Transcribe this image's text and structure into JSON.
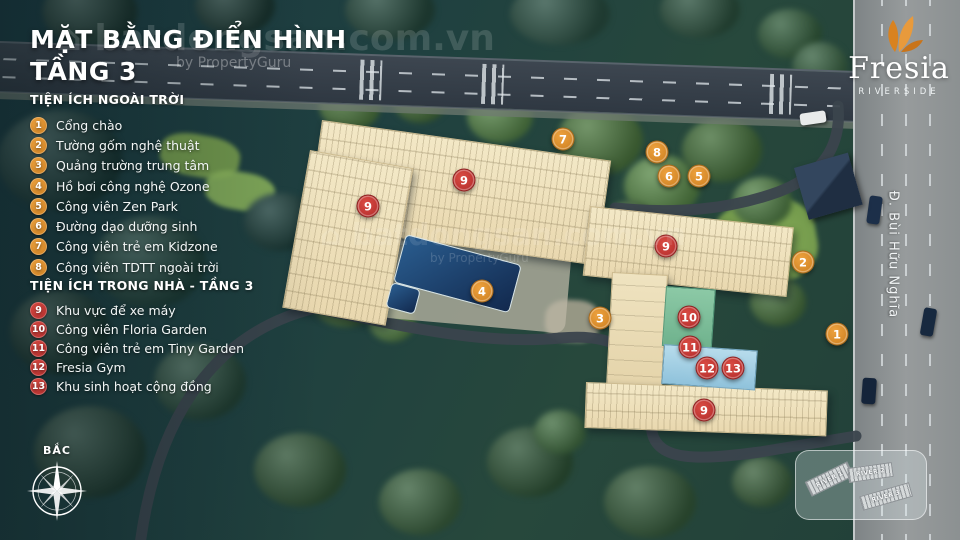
{
  "title": {
    "line1": "MẶT BẰNG ĐIỂN HÌNH",
    "line2": "TẦNG 3"
  },
  "legend_outdoor": {
    "heading": "TIỆN ÍCH NGOÀI TRỜI",
    "items": [
      {
        "num": "1",
        "label": "Cổng chào"
      },
      {
        "num": "2",
        "label": "Tường gốm nghệ thuật"
      },
      {
        "num": "3",
        "label": "Quảng trường trung tâm"
      },
      {
        "num": "4",
        "label": "Hồ bơi công nghệ Ozone"
      },
      {
        "num": "5",
        "label": "Công viên Zen Park"
      },
      {
        "num": "6",
        "label": "Đường dạo dưỡng sinh"
      },
      {
        "num": "7",
        "label": "Công viên trẻ em Kidzone"
      },
      {
        "num": "8",
        "label": "Công viên TDTT ngoài trời"
      }
    ]
  },
  "legend_indoor": {
    "heading": "TIỆN ÍCH TRONG NHÀ - TẦNG 3",
    "items": [
      {
        "num": "9",
        "label": "Khu vực để xe máy"
      },
      {
        "num": "10",
        "label": "Công viên Floria Garden"
      },
      {
        "num": "11",
        "label": "Công viên trẻ em Tiny Garden"
      },
      {
        "num": "12",
        "label": "Fresia Gym"
      },
      {
        "num": "13",
        "label": "Khu sinh hoạt cộng đồng"
      }
    ]
  },
  "logo": {
    "name": "Fresia",
    "subtitle": "RIVERSIDE"
  },
  "map": {
    "street_label": "Đ. Bùi Hữu Nghĩa",
    "markers": [
      {
        "num": "7",
        "kind": "outdoor",
        "x": 563,
        "y": 139
      },
      {
        "num": "8",
        "kind": "outdoor",
        "x": 657,
        "y": 152
      },
      {
        "num": "6",
        "kind": "outdoor",
        "x": 669,
        "y": 176
      },
      {
        "num": "5",
        "kind": "outdoor",
        "x": 699,
        "y": 176
      },
      {
        "num": "2",
        "kind": "outdoor",
        "x": 803,
        "y": 262
      },
      {
        "num": "1",
        "kind": "outdoor",
        "x": 837,
        "y": 334
      },
      {
        "num": "3",
        "kind": "outdoor",
        "x": 600,
        "y": 318
      },
      {
        "num": "4",
        "kind": "outdoor",
        "x": 482,
        "y": 291
      },
      {
        "num": "9",
        "kind": "indoor",
        "x": 368,
        "y": 206
      },
      {
        "num": "9",
        "kind": "indoor",
        "x": 464,
        "y": 180
      },
      {
        "num": "9",
        "kind": "indoor",
        "x": 666,
        "y": 246
      },
      {
        "num": "9",
        "kind": "indoor",
        "x": 704,
        "y": 410
      },
      {
        "num": "10",
        "kind": "indoor",
        "x": 689,
        "y": 317
      },
      {
        "num": "11",
        "kind": "indoor",
        "x": 690,
        "y": 347
      },
      {
        "num": "12",
        "kind": "indoor",
        "x": 707,
        "y": 368
      },
      {
        "num": "13",
        "kind": "indoor",
        "x": 733,
        "y": 368
      }
    ]
  },
  "compass": {
    "label": "BẮC"
  },
  "inset": {
    "blocks": [
      "RIVER 1",
      "RIVER 2",
      "RIVER 3"
    ]
  },
  "watermark": {
    "icon": "⌂",
    "brand": "batdongsan.com.vn",
    "byline": "by PropertyGuru"
  },
  "colors": {
    "outdoor_badge": "#d8862b",
    "indoor_badge": "#c33a38",
    "building": "#f1e5c2",
    "pool": "#1f4470",
    "logo_flower": "#e08e2c",
    "background_forest": "#1f4040"
  }
}
